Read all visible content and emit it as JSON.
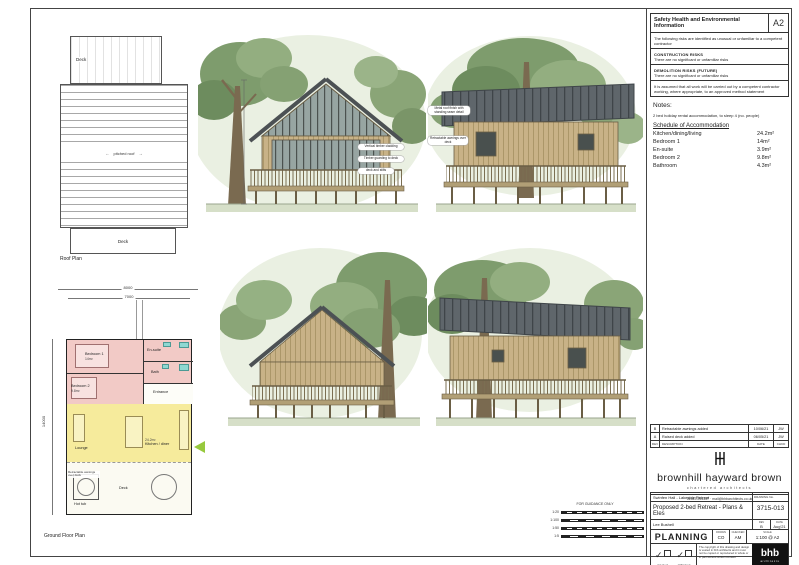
{
  "sheet": {
    "paper_size": "A2",
    "colors": {
      "accent_green": "#97c93d",
      "zone_pink": "#f2cac6",
      "zone_yellow": "#f6eb9c",
      "roof_grey": "#5f666b",
      "timber": "#c8b287"
    },
    "safety": {
      "title": "Safety Health and Environmental Information",
      "intro": "The following risks are identified as unusual or unfamiliar to a competent contractor",
      "construction_heading": "CONSTRUCTION RISKS",
      "construction_text": "There are no significant or unfamiliar risks",
      "demolition_heading": "DEMOLITION RISKS (FUTURE)",
      "demolition_text": "There are no significant or unfamiliar risks",
      "assumption": "It is assumed that all work will be carried out by a competent contractor working, where appropriate, to an approved method statement"
    },
    "notes": {
      "heading": "Notes:",
      "note": "2 bed holiday rental accommodation, to sleep 4 (no. people)",
      "schedule_heading": "Schedule of Accommodation",
      "schedule": [
        {
          "room": "Kitchen/dining/living",
          "area": "24.2m²"
        },
        {
          "room": "Bedroom 1",
          "area": "14m²"
        },
        {
          "room": "En-suite",
          "area": "3.9m²"
        },
        {
          "room": "Bedroom 2",
          "area": "9.8m²"
        },
        {
          "room": "Bathroom",
          "area": "4.3m²"
        }
      ]
    },
    "roof_plan": {
      "caption": "Roof Plan",
      "deck_top": "Deck",
      "deck_bottom": "Deck",
      "pitch_label": "pitched roof",
      "arrow_left": "←",
      "arrow_right": "→"
    },
    "ground_floor": {
      "caption": "Ground Floor Plan",
      "dim_outer": "8000",
      "dim_inner": "7000",
      "dim_left": "14000",
      "bedroom1": "Bedroom 1",
      "bedroom1_area": "14m²",
      "bedroom2": "Bedroom 2",
      "bedroom2_area": "9.8m²",
      "ensuite": "En-suite",
      "bath": "Bath",
      "entrance": "Entrance",
      "lounge": "Lounge",
      "kitchen_area": "24.2m²",
      "kitchen": "Kitchen / diner",
      "hot_tub": "Hot tub",
      "deck": "Deck",
      "awning_note": "Retractable awnings over deck"
    },
    "elevations": {
      "front_callouts": [
        "Vertical timber cladding",
        "Timber guarding to deck",
        "deck and stilts"
      ],
      "side_callouts": [
        "Metal roof finish with standing seam detail",
        "Retractable awnings over deck"
      ]
    },
    "scale_bar": {
      "title": "FOR GUIDANCE ONLY",
      "rows": [
        "1:20",
        "1:100",
        "1:50",
        "1:5"
      ]
    },
    "revisions": {
      "header": {
        "rev": "REV",
        "desc": "DESCRIPTION",
        "date": "DATE",
        "by": "CHKD"
      },
      "rows": [
        {
          "rev": "B",
          "desc": "Retractable awnings added",
          "date": "10/06/21",
          "by": "JW"
        },
        {
          "rev": "A",
          "desc": "Raised deck added",
          "date": "06/05/21",
          "by": "JW"
        }
      ]
    },
    "firm": {
      "name": "brownhill hayward brown",
      "tagline": "chartered architects",
      "contact": "01543 254357  ·  mail@bhbarchitects.co.uk"
    },
    "title_block": {
      "project": "Swinfen Hall - Lakeside Retreat",
      "drawing_title": "Proposed 2-bed Retreat - Plans & Eles",
      "client": "Lee Bushell",
      "drawing_no_label": "DRAWING No.",
      "drawing_no": "3715-013",
      "rev_label": "REV",
      "rev": "B",
      "date_label": "DATE",
      "date": "Aug'21",
      "status": "PLANNING",
      "drawn_label": "DRAWN",
      "drawn": "CO",
      "checked_label": "CHECKED",
      "checked": "AM",
      "scale_label": "SCALE",
      "scale": "1:100 @ A2"
    },
    "footer": {
      "check1": "QA check",
      "check2": "CDM check",
      "disclaimer": "The copyright of this drawing and design is vested in bhb architects and it must not be copied or reproduced in whole or in part without written consent",
      "logo_main": "bhb",
      "logo_sub": "architects"
    }
  }
}
